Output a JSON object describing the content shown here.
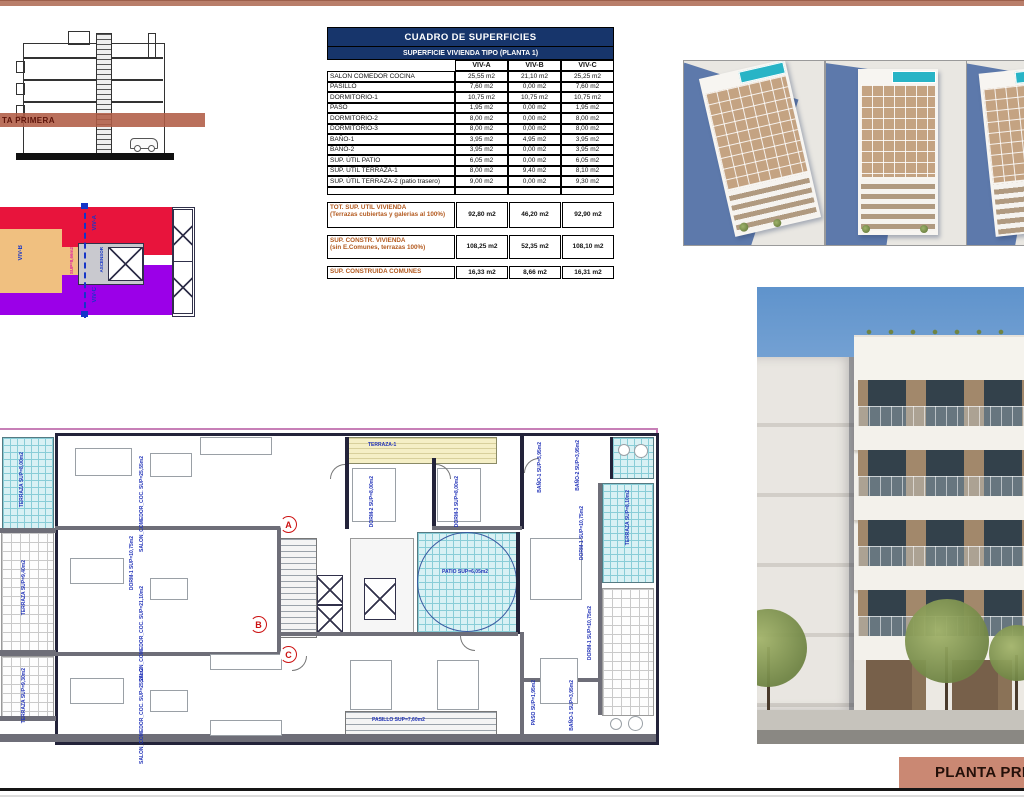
{
  "section_drawing": {
    "band_label": "TA PRIMERA"
  },
  "key_plan": {
    "units": [
      {
        "label": "VIV-A",
        "color": "#e8143c"
      },
      {
        "label": "VIV-B",
        "color": "#f0c080"
      },
      {
        "label": "VIV-C",
        "color": "#9b00e8"
      }
    ],
    "core_labels": [
      "ASCENSOR",
      "SUP=8,66m2"
    ]
  },
  "table": {
    "title": "CUADRO DE SUPERFICIES",
    "subtitle": "SUPERFICIE VIVIENDA TIPO  (PLANTA 1)",
    "columns": [
      "VIV-A",
      "VIV-B",
      "VIV-C"
    ],
    "rows": [
      {
        "label": "SALON COMEDOR COCINA",
        "a": "25,55 m2",
        "b": "21,10 m2",
        "c": "25,25 m2"
      },
      {
        "label": "PASILLO",
        "a": "7,60 m2",
        "b": "0,00 m2",
        "c": "7,60 m2"
      },
      {
        "label": "DORMITORIO-1",
        "a": "10,75 m2",
        "b": "10,75 m2",
        "c": "10,75 m2"
      },
      {
        "label": "PASO",
        "a": "1,95 m2",
        "b": "0,00 m2",
        "c": "1,95 m2"
      },
      {
        "label": "DORMITORIO-2",
        "a": "8,00 m2",
        "b": "0,00 m2",
        "c": "8,00 m2"
      },
      {
        "label": "DORMITORIO-3",
        "a": "8,00 m2",
        "b": "0,00 m2",
        "c": "8,00 m2"
      },
      {
        "label": "BAÑO-1",
        "a": "3,95 m2",
        "b": "4,95 m2",
        "c": "3,95 m2"
      },
      {
        "label": "BAÑO-2",
        "a": "3,95 m2",
        "b": "0,00 m2",
        "c": "3,95 m2"
      },
      {
        "label": "SUP. ÚTIL PATIO",
        "a": "6,05 m2",
        "b": "0,00 m2",
        "c": "6,05 m2"
      },
      {
        "label": "SUP. ÚTIL TERRAZA-1",
        "a": "8,00 m2",
        "b": "9,40 m2",
        "c": "8,10 m2"
      },
      {
        "label": "SUP. ÚTIL TERRAZA-2 (patio trasero)",
        "a": "9,00 m2",
        "b": "0,00 m2",
        "c": "9,30 m2"
      }
    ],
    "summary": [
      {
        "label": "TOT. SUP. UTIL VIVIENDA",
        "note": "(Terrazas cubiertas y galerias al 100%)",
        "a": "92,80 m2",
        "b": "46,20 m2",
        "c": "92,90 m2"
      },
      {
        "label": "SUP. CONSTR. VIVIENDA",
        "note": "(sin E.Comunes, terrazas 100%)",
        "a": "108,25 m2",
        "b": "52,35 m2",
        "c": "108,10 m2"
      },
      {
        "label": "SUP. CONSTRUIDA COMUNES",
        "note": "",
        "a": "16,33 m2",
        "b": "8,66 m2",
        "c": "16,31 m2"
      }
    ]
  },
  "floor_plan": {
    "labels": [
      "TERRAZA SUP=8,00m2",
      "SALON_COMEDOR_COC. SUP=25,55m2",
      "DORM-1 SUP=10,75m2",
      "SALON_COMEDOR_COC. SUP=21,10m2",
      "SALON_COMEDOR_COC. SUP=25,25m2",
      "TERRAZA SUP=9,40m2",
      "TERRAZA SUP=9,30m2",
      "TERRAZA-1",
      "DORM-2 SUP=8,00m2",
      "DORM-3 SUP=8,00m2",
      "BAÑO-1 SUP=3,95m2",
      "BAÑO-2 SUP=3,95m2",
      "DORM-1 SUP=10,75m2",
      "TERRAZA SUP=8,10m2",
      "PATIO SUP=6,05m2",
      "PASO SUP=1,95m2",
      "BAÑO-1 SUP=3,95m2",
      "DORM-1 SUP=10,75m2",
      "PASILLO SUP=7,60m2"
    ],
    "unit_markers": [
      "A",
      "B",
      "C"
    ]
  },
  "title_block": {
    "label": "PLANTA PRIMERA"
  },
  "colors": {
    "accent_bar": "#b97e6a",
    "table_header": "#17356b",
    "summary_text": "#b35a1f",
    "band": "#b25c46",
    "plan_terrace": "#d8f1f4",
    "plan_label": "#2233b8",
    "marker_red": "#cc1111"
  }
}
